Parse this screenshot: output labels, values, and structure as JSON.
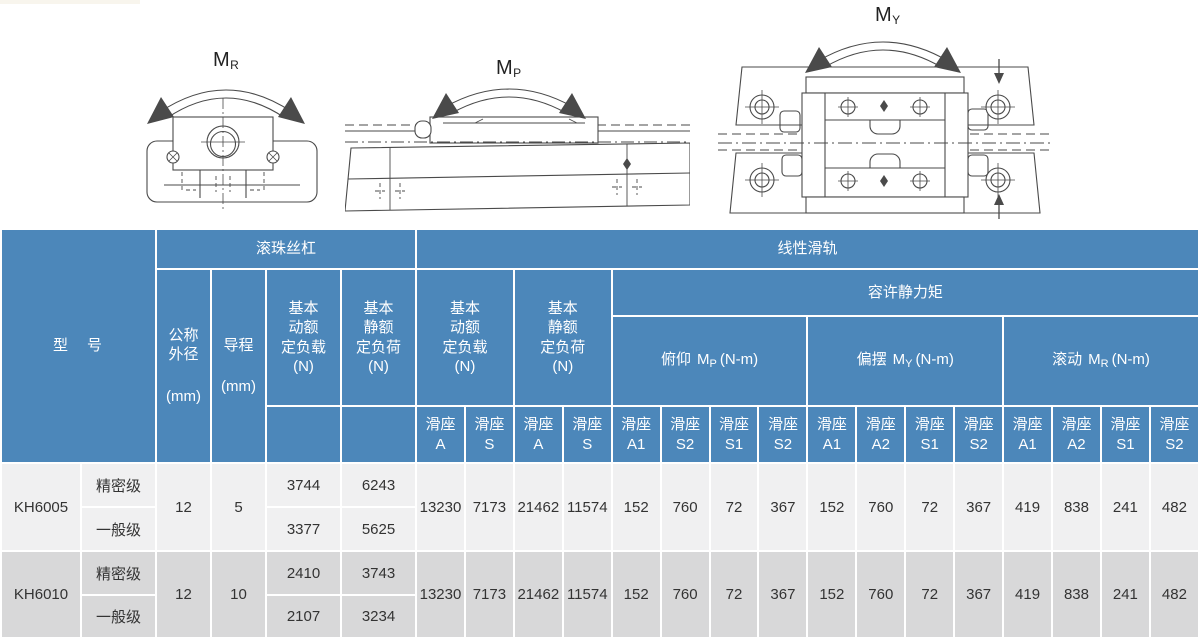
{
  "diagrams": [
    {
      "name": "rolling-moment-front-view",
      "m": "M",
      "sub": "R"
    },
    {
      "name": "pitching-moment-side-view",
      "m": "M",
      "sub": "P"
    },
    {
      "name": "yawing-moment-top-view",
      "m": "M",
      "sub": "Y"
    }
  ],
  "colors": {
    "header-blue": "#4c87ba",
    "row-light": "#f0f0f1",
    "row-dark": "#d8d8d9",
    "grid-white": "#ffffff",
    "body-text": "#333333",
    "line-gray": "#4a4a4a"
  },
  "table": {
    "header": {
      "model": "型　号",
      "ball_screw": "滚珠丝杠",
      "linear_rail": "线性滑轨",
      "nominal_od": "公称\n外径",
      "nominal_od_unit": "(mm)",
      "lead": "导程",
      "lead_unit": "(mm)",
      "bs_dynamic": "基本\n动额\n定负载\n(N)",
      "bs_static": "基本\n静额\n定负荷\n(N)",
      "lr_dynamic": "基本\n动额\n定负载\n(N)",
      "lr_static": "基本\n静额\n定负荷\n(N)",
      "static_moment": "容许静力矩",
      "moment_cols": [
        {
          "prefix": "俯仰",
          "m": "M",
          "sub": "P",
          "unit": "(N-m)"
        },
        {
          "prefix": "偏摆",
          "m": "M",
          "sub": "Y",
          "unit": "(N-m)"
        },
        {
          "prefix": "滚动",
          "m": "M",
          "sub": "R",
          "unit": "(N-m)"
        }
      ],
      "slider_cols": [
        {
          "t": "滑座",
          "s": "A"
        },
        {
          "t": "滑座",
          "s": "S"
        },
        {
          "t": "滑座",
          "s": "A"
        },
        {
          "t": "滑座",
          "s": "S"
        },
        {
          "t": "滑座",
          "s": "A1"
        },
        {
          "t": "滑座",
          "s": "S2"
        },
        {
          "t": "滑座",
          "s": "S1"
        },
        {
          "t": "滑座",
          "s": "S2"
        },
        {
          "t": "滑座",
          "s": "A1"
        },
        {
          "t": "滑座",
          "s": "A2"
        },
        {
          "t": "滑座",
          "s": "S1"
        },
        {
          "t": "滑座",
          "s": "S2"
        },
        {
          "t": "滑座",
          "s": "A1"
        },
        {
          "t": "滑座",
          "s": "A2"
        },
        {
          "t": "滑座",
          "s": "S1"
        },
        {
          "t": "滑座",
          "s": "S2"
        }
      ]
    },
    "body": [
      {
        "model": "KH6005",
        "grades": [
          "精密级",
          "一般级"
        ],
        "od": "12",
        "lead": "5",
        "bs": [
          [
            "3744",
            "6243"
          ],
          [
            "3377",
            "5625"
          ]
        ],
        "values": [
          "13230",
          "7173",
          "21462",
          "11574",
          "152",
          "760",
          "72",
          "367",
          "152",
          "760",
          "72",
          "367",
          "419",
          "838",
          "241",
          "482"
        ]
      },
      {
        "model": "KH6010",
        "grades": [
          "精密级",
          "一般级"
        ],
        "od": "12",
        "lead": "10",
        "bs": [
          [
            "2410",
            "3743"
          ],
          [
            "2107",
            "3234"
          ]
        ],
        "values": [
          "13230",
          "7173",
          "21462",
          "11574",
          "152",
          "760",
          "72",
          "367",
          "152",
          "760",
          "72",
          "367",
          "419",
          "838",
          "241",
          "482"
        ]
      }
    ]
  }
}
